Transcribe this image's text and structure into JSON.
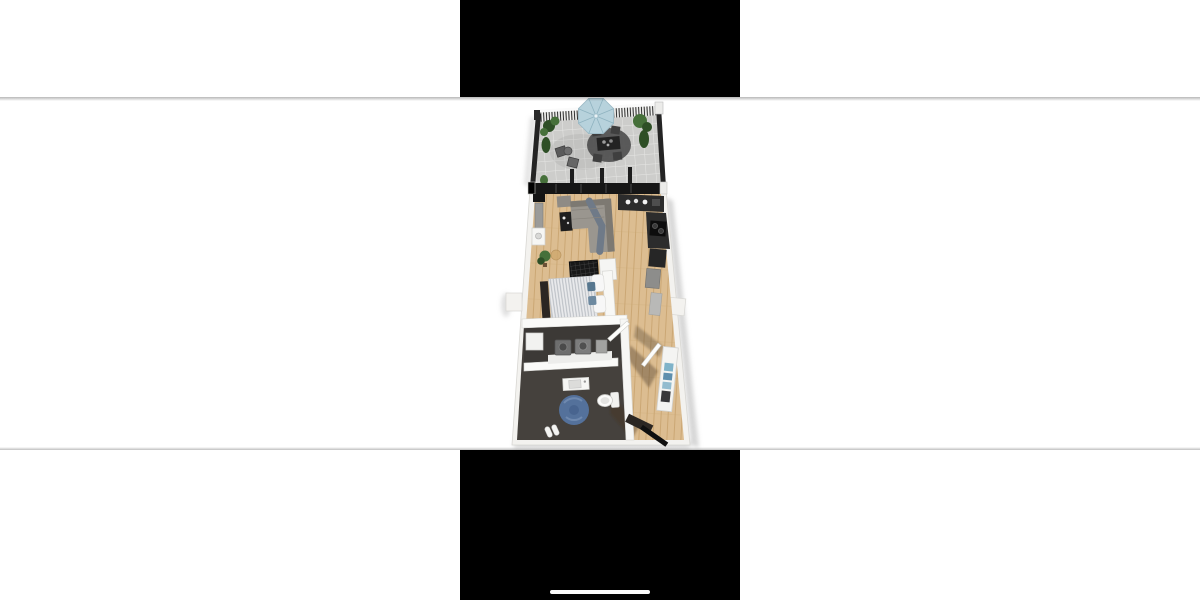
{
  "phone": {
    "letterbox_top": true,
    "letterbox_bottom": true,
    "home_indicator": true
  },
  "photo": {
    "content": "3D rendered top-down floor plan of a narrow one-room apartment with roof terrace",
    "rooms": [
      "terrace",
      "living-room",
      "kitchen",
      "sleeping-area",
      "laundry",
      "bathroom",
      "entry-hall"
    ],
    "furniture": [
      "parasol",
      "outdoor-dining-set",
      "bistro-chairs",
      "plants",
      "sofa",
      "side-table",
      "tv-panel",
      "kitchen-counter",
      "cooktop",
      "bed",
      "foot-bench",
      "divider-screen",
      "washer-dryer",
      "sink-vanity",
      "toilet",
      "blue-round-rug",
      "slippers",
      "wardrobe",
      "entrance-door"
    ]
  },
  "colors": {
    "canvas": "#ffffff",
    "letterbox": "#000000",
    "home_indicator": "#fafafa",
    "wall": "#f3f2ef",
    "wall_edge": "#d8d7d3",
    "wood": "#dcbd91",
    "wood_line": "#c9a571",
    "terrace_tile": "#cdcdcb",
    "tile_grout": "#e6e6e4",
    "dark_floor": "#45413d",
    "dark_floor2": "#3b3835",
    "umbrella": "#b7d2dc",
    "umbrella_rib": "#8fb3c0",
    "plant": "#46703a",
    "plant_dark": "#2e4f26",
    "sofa": "#9a968f",
    "sofa_dark": "#7d7972",
    "throw_blanket": "#6f7a88",
    "black_furniture": "#1e1e1e",
    "kitchen_dark": "#2c2c2c",
    "kitchen_mid": "#4a4a4a",
    "rug_terrace": "#4f4f4f",
    "rug_blue": "#54719b",
    "rug_blue_light": "#7690b4",
    "duvet": "#e9eaec",
    "duvet_stripe": "#b7bcc2",
    "pillow": "#f7f7f7",
    "accent_pillow": "#57778f",
    "bench_dark": "#2b2622",
    "closet_blue": "#7fb3c9",
    "counter_white": "#ededeb",
    "machine_gray": "#6e6e6e",
    "glass_dark": "#161616",
    "fence_dark": "#242424"
  }
}
